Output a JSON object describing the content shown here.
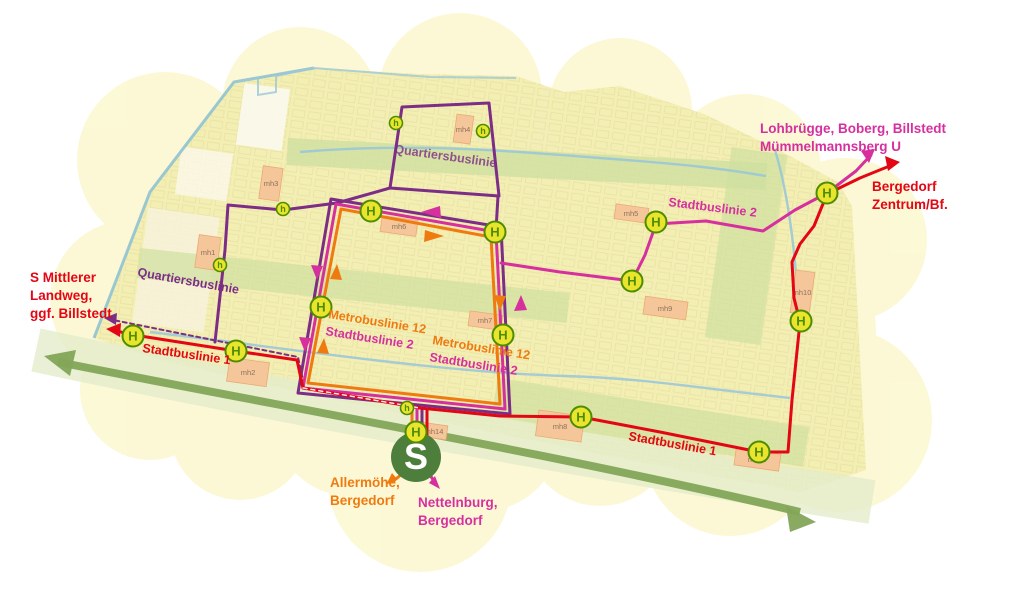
{
  "colors": {
    "stadtbuslinie_1_red": "#e30615",
    "stadtbuslinie_2_magenta": "#d6309f",
    "metrobuslinie_12_orange": "#ef7b10",
    "quartiersbuslinie_purple": "#7c2d86",
    "stop_green": "#4e8c00",
    "stop_yellow": "#e9e52f",
    "sbahn_green": "#4e7e3c",
    "hub_tan": "#f6c69b",
    "greenway_green": "#83a557"
  },
  "letters": {
    "stop": "H",
    "stop_small": "h",
    "sbahn": "S"
  },
  "destinations": {
    "lohbruegge_line1": "Lohbrügge, Boberg, Billstedt",
    "lohbruegge_line2": "Mümmelmannsberg U",
    "bergedorf_line1": "Bergedorf",
    "bergedorf_line2": "Zentrum/Bf.",
    "mittlerer_landweg_line1": "S Mittlerer",
    "mittlerer_landweg_line2": "Landweg,",
    "mittlerer_landweg_line3": "ggf. Billstedt",
    "allermoehe_line1": "Allermöhe,",
    "allermoehe_line2": "Bergedorf",
    "nettelnburg_line1": "Nettelnburg,",
    "nettelnburg_line2": "Bergedorf"
  },
  "route_labels": {
    "stadtbuslinie1_west": "Stadtbuslinie 1",
    "stadtbuslinie1_east": "Stadtbuslinie 1",
    "stadtbuslinie2_northeast": "Stadtbuslinie 2",
    "quartiersbuslinie_west": "Quartiersbuslinie",
    "quartiersbuslinie_north": "Quartiersbuslinie",
    "loop_label_west_line1": "Metrobuslinie 12",
    "loop_label_west_line2": "Stadtbuslinie 2",
    "loop_label_center_line1": "Metrobuslinie 12",
    "loop_label_center_line2": "Stadtbuslinie 2"
  },
  "hubs": {
    "mh1": "mh1",
    "mh2": "mh2",
    "mh3": "mh3",
    "mh4": "mh4",
    "mh5": "mh5",
    "mh6": "mh6",
    "mh7": "mh7",
    "mh8": "mh8",
    "mh9": "mh9",
    "mh10": "mh10",
    "mh11": "mh11",
    "mh14": "mh14"
  }
}
